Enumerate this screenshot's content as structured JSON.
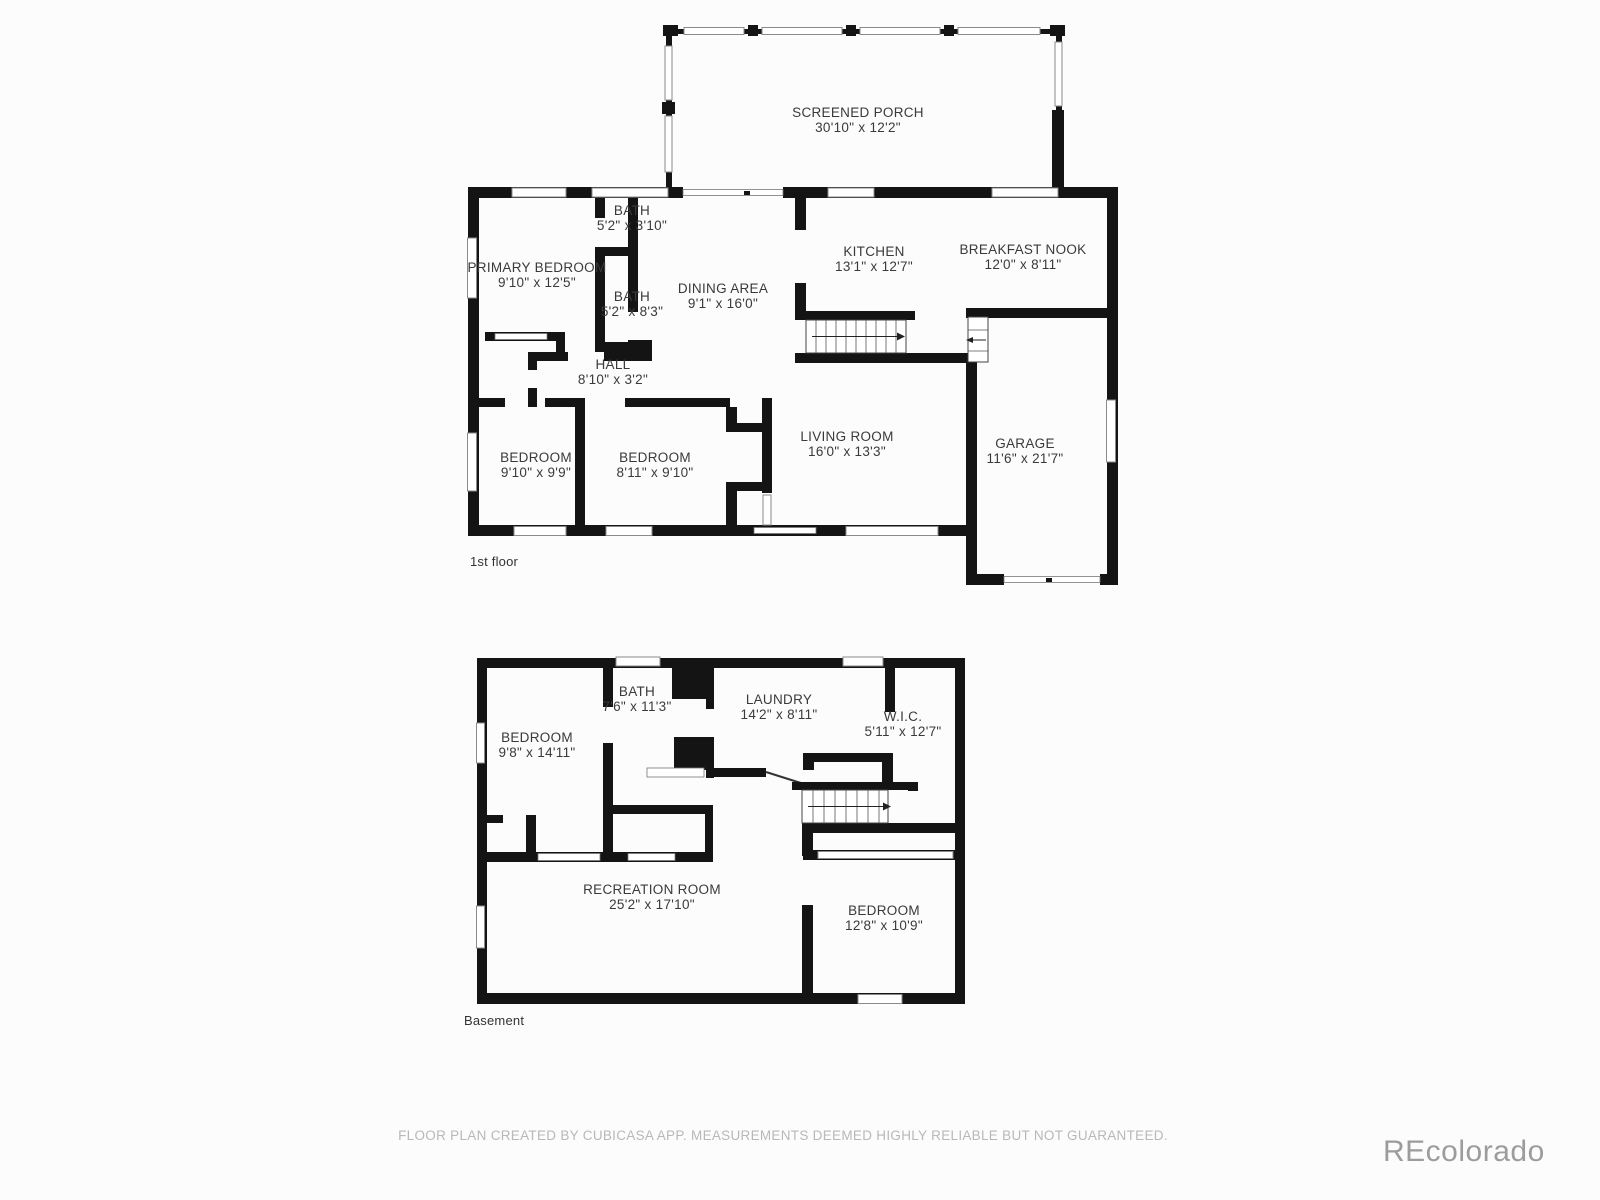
{
  "floors": [
    {
      "id": "first-floor",
      "caption": "1st floor",
      "rooms": [
        {
          "name": "SCREENED PORCH",
          "dims": "30'10\" x 12'2\""
        },
        {
          "name": "PRIMARY BEDROOM",
          "dims": "9'10\" x 12'5\""
        },
        {
          "name": "BATH",
          "dims": "5'2\" x 3'10\""
        },
        {
          "name": "BATH",
          "dims": "5'2\" x 8'3\""
        },
        {
          "name": "DINING AREA",
          "dims": "9'1\" x 16'0\""
        },
        {
          "name": "KITCHEN",
          "dims": "13'1\" x 12'7\""
        },
        {
          "name": "BREAKFAST NOOK",
          "dims": "12'0\" x 8'11\""
        },
        {
          "name": "HALL",
          "dims": "8'10\" x 3'2\""
        },
        {
          "name": "BEDROOM",
          "dims": "9'10\" x 9'9\""
        },
        {
          "name": "BEDROOM",
          "dims": "8'11\" x 9'10\""
        },
        {
          "name": "LIVING ROOM",
          "dims": "16'0\" x 13'3\""
        },
        {
          "name": "GARAGE",
          "dims": "11'6\" x 21'7\""
        }
      ]
    },
    {
      "id": "basement",
      "caption": "Basement",
      "rooms": [
        {
          "name": "BEDROOM",
          "dims": "9'8\" x 14'11\""
        },
        {
          "name": "BATH",
          "dims": "7'6\" x 11'3\""
        },
        {
          "name": "LAUNDRY",
          "dims": "14'2\" x 8'11\""
        },
        {
          "name": "W.I.C.",
          "dims": "5'11\" x 12'7\""
        },
        {
          "name": "RECREATION ROOM",
          "dims": "25'2\" x 17'10\""
        },
        {
          "name": "BEDROOM",
          "dims": "12'8\" x 10'9\""
        }
      ]
    }
  ],
  "footer": {
    "disclaimer": "FLOOR PLAN CREATED BY CUBICASA APP. MEASUREMENTS DEEMED HIGHLY RELIABLE BUT NOT GUARANTEED."
  },
  "watermark": {
    "text": "REcolorado"
  },
  "colors": {
    "wall": "#141414",
    "label": "#3a3a3a",
    "muted": "#b8b8b8",
    "watermark": "#9c9c9c"
  }
}
